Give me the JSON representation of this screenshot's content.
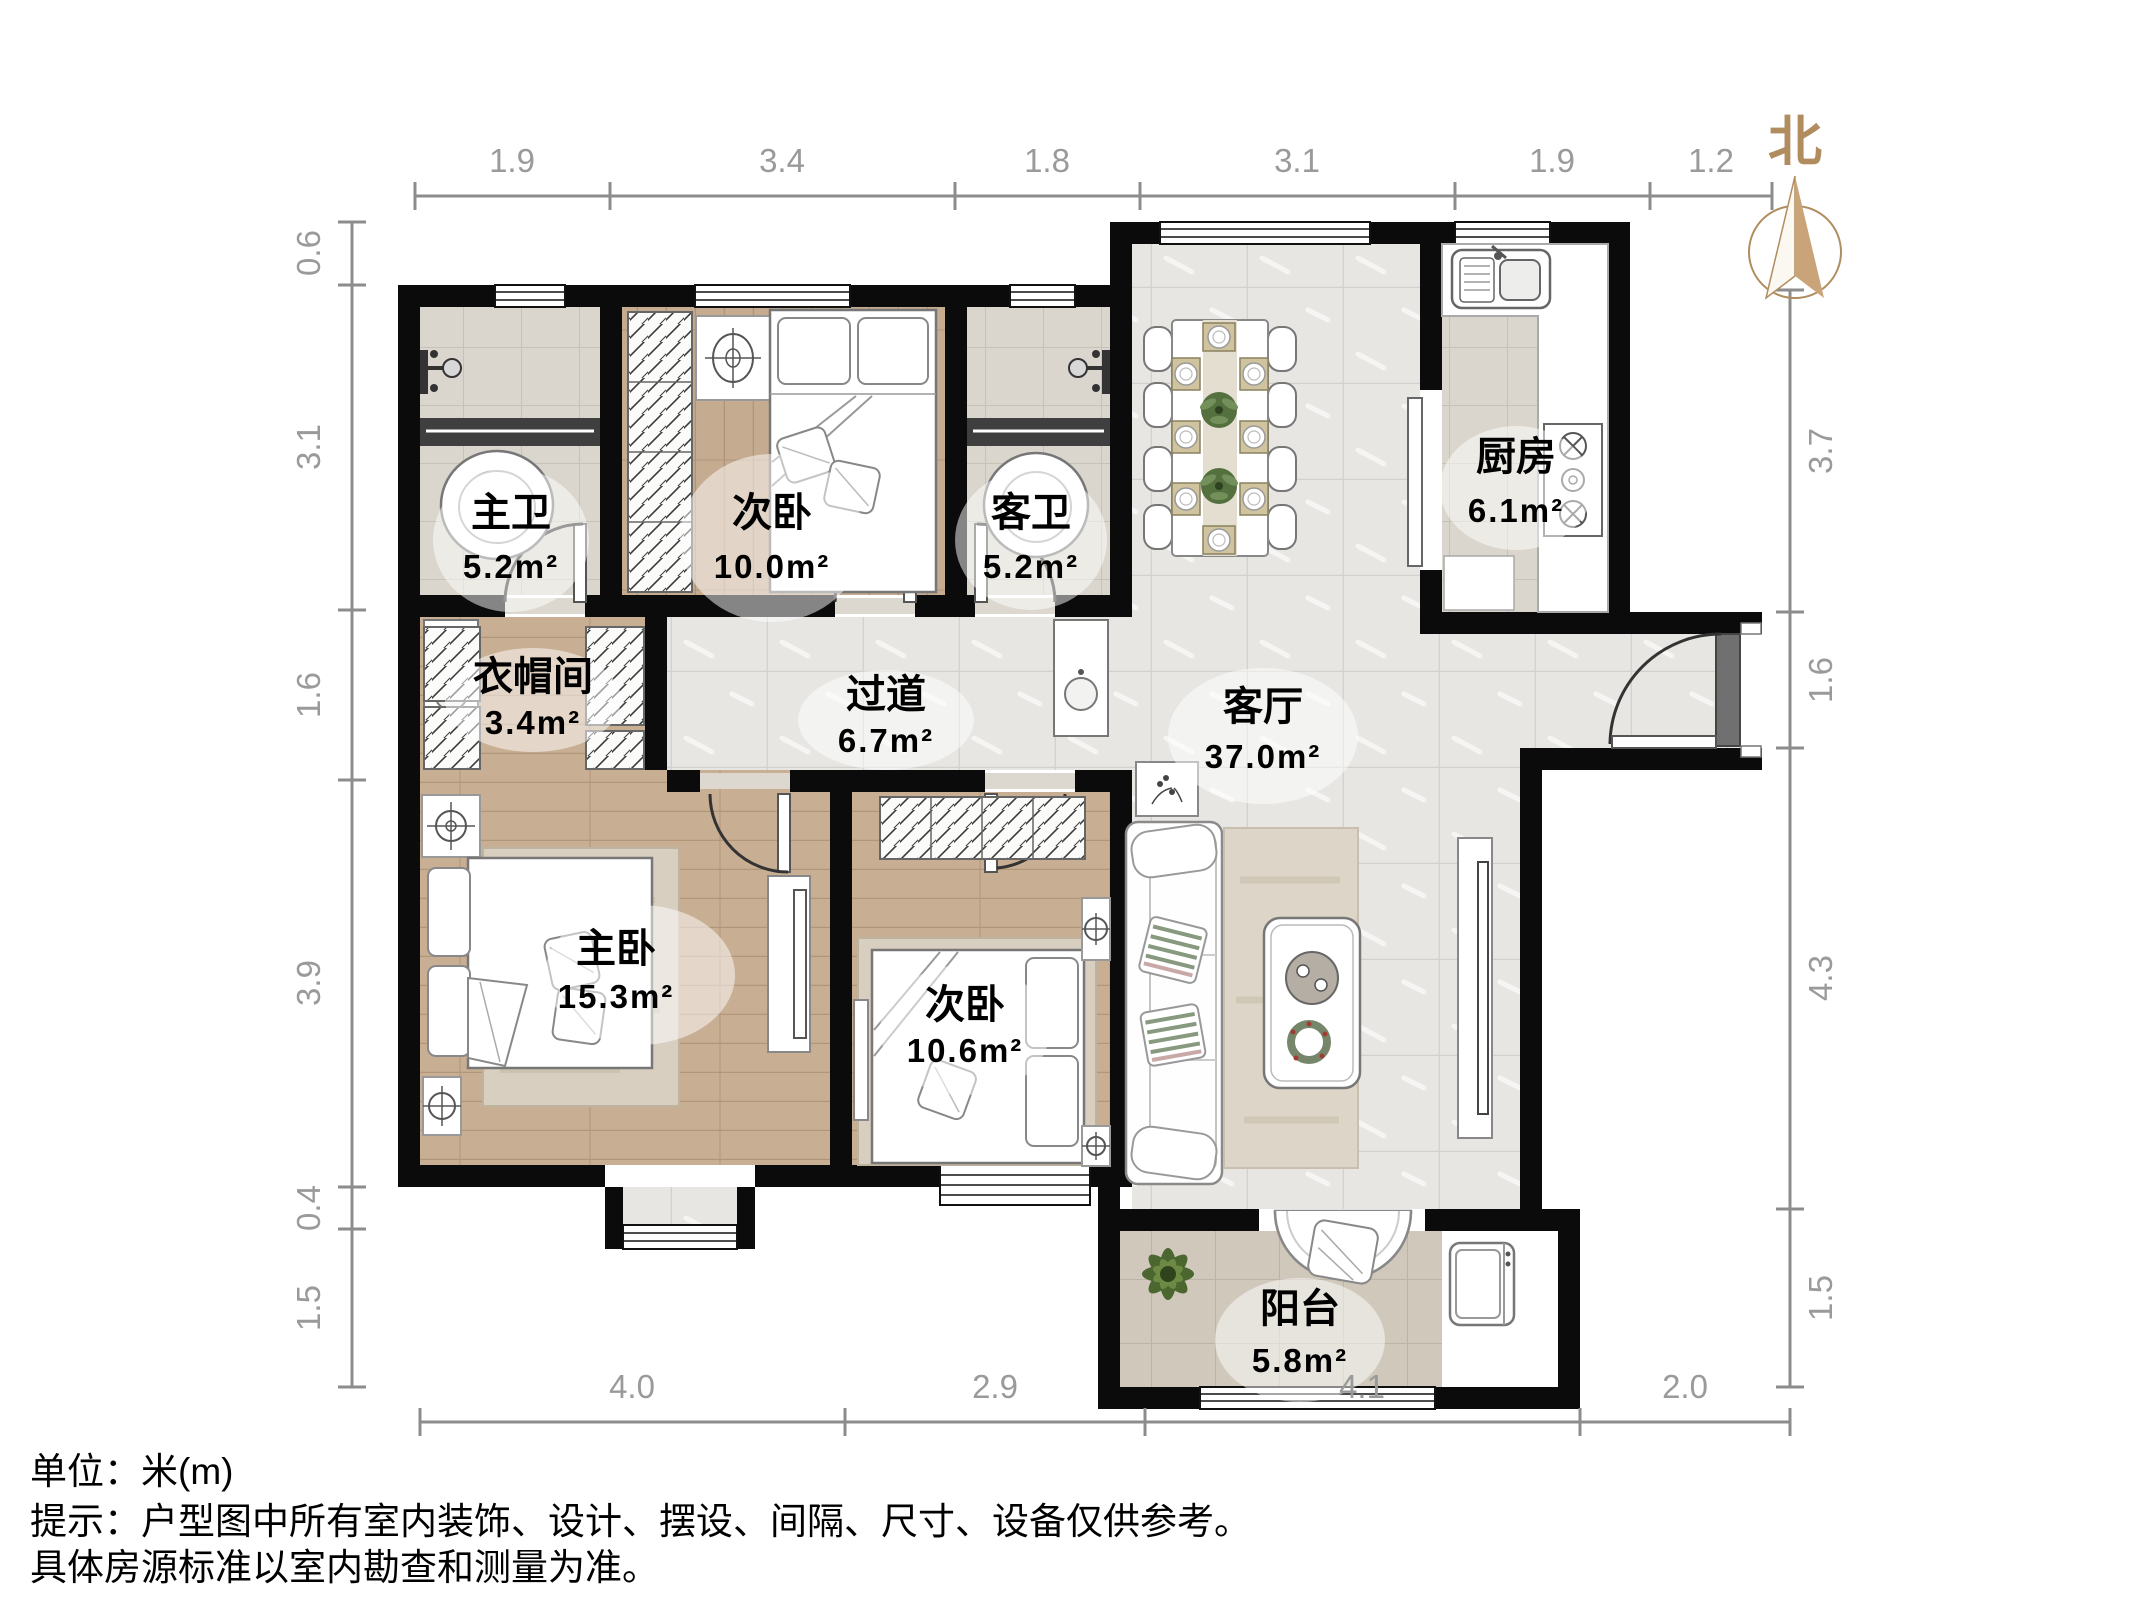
{
  "compass": {
    "north_label": "北"
  },
  "dimensions": {
    "top": [
      "1.9",
      "3.4",
      "1.8",
      "3.1",
      "1.9",
      "1.2"
    ],
    "left": [
      "0.6",
      "3.1",
      "1.6",
      "3.9",
      "0.4",
      "1.5"
    ],
    "right": [
      "3.7",
      "1.6",
      "4.3",
      "1.5"
    ],
    "bottom": [
      "4.0",
      "2.9",
      "4.1",
      "2.0"
    ]
  },
  "rooms": {
    "master_bath": {
      "name": "主卫",
      "area": "5.2m²"
    },
    "bedroom2_north": {
      "name": "次卧",
      "area": "10.0m²"
    },
    "guest_bath": {
      "name": "客卫",
      "area": "5.2m²"
    },
    "kitchen": {
      "name": "厨房",
      "area": "6.1m²"
    },
    "cloakroom": {
      "name": "衣帽间",
      "area": "3.4m²"
    },
    "hallway": {
      "name": "过道",
      "area": "6.7m²"
    },
    "living_room": {
      "name": "客厅",
      "area": "37.0m²"
    },
    "master_bedroom": {
      "name": "主卧",
      "area": "15.3m²"
    },
    "bedroom2_south": {
      "name": "次卧",
      "area": "10.6m²"
    },
    "balcony": {
      "name": "阳台",
      "area": "5.8m²"
    }
  },
  "footer": {
    "line1": "单位：米(m)",
    "line2": "提示：户型图中所有室内装饰、设计、摆设、间隔、尺寸、设备仅供参考。",
    "line3": "具体房源标准以室内勘查和测量为准。"
  },
  "colors": {
    "wall": "#0b0b0b",
    "wood_floor": "#c8ae92",
    "tile_floor": "#e7e6e3",
    "bath_tile": "#dad6cd",
    "balcony_tile": "#cfc8bb",
    "dimension_gray": "#9a9a9a",
    "compass_accent": "#b08c5f"
  }
}
